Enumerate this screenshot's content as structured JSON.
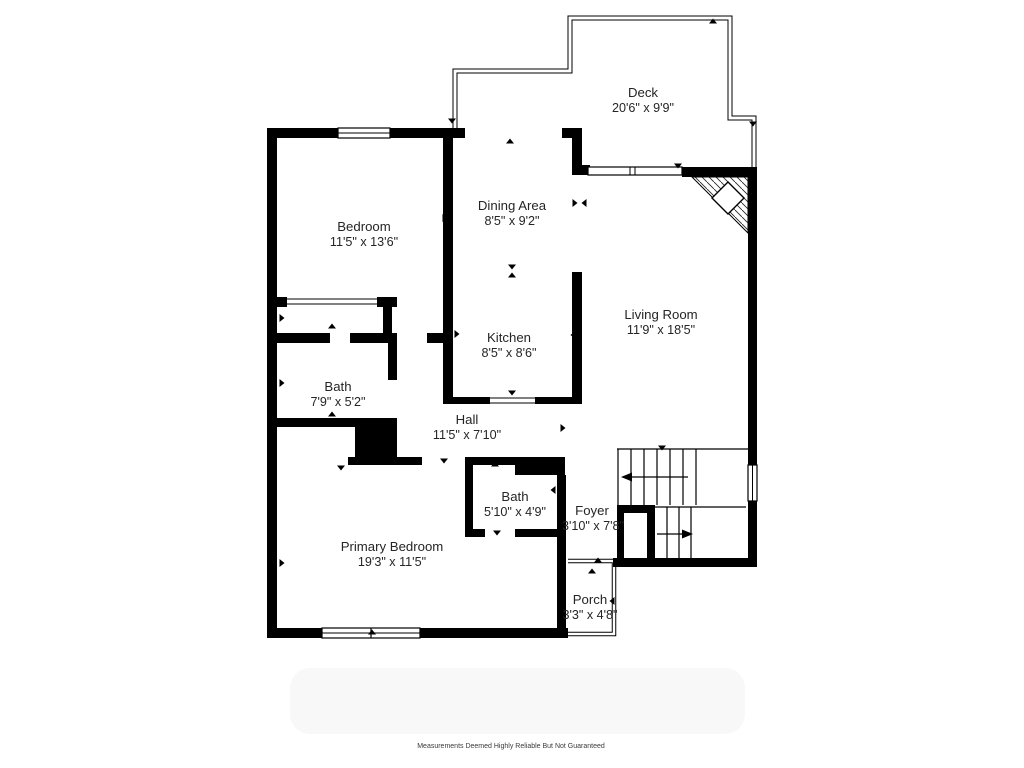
{
  "floor_plan": {
    "rooms": [
      {
        "name": "Deck",
        "dims": "20'6\" x 9'9\""
      },
      {
        "name": "Bedroom",
        "dims": "11'5\" x 13'6\""
      },
      {
        "name": "Dining Area",
        "dims": "8'5\" x 9'2\""
      },
      {
        "name": "Living Room",
        "dims": "11'9\" x 18'5\""
      },
      {
        "name": "Kitchen",
        "dims": "8'5\" x 8'6\""
      },
      {
        "name": "Bath",
        "dims": "7'9\" x 5'2\""
      },
      {
        "name": "Hall",
        "dims": "11'5\" x 7'10\""
      },
      {
        "name": "Bath",
        "dims": "5'10\" x 4'9\""
      },
      {
        "name": "Foyer",
        "dims": "3'10\" x 7'8\""
      },
      {
        "name": "Primary Bedroom",
        "dims": "19'3\" x 11'5\""
      },
      {
        "name": "Porch",
        "dims": "3'3\" x 4'8\""
      }
    ],
    "footer": "Measurements Deemed Highly Reliable But Not Guaranteed",
    "colors": {
      "wall": "#000000",
      "background": "#ffffff",
      "watermark_area": "#f8f8f8",
      "label_text": "#252525",
      "footer_text": "#3a3a3a"
    }
  }
}
